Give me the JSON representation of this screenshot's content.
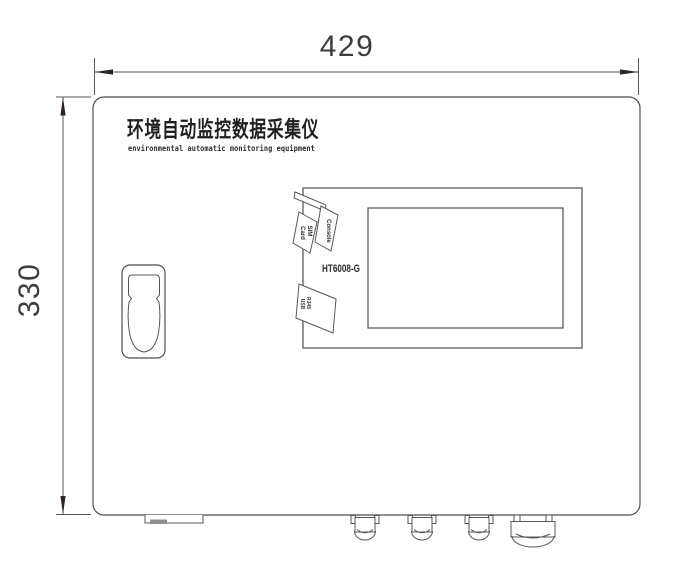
{
  "drawing": {
    "kind": "front-view engineering drawing of wall-mounted data collector cabinet",
    "colors": {
      "line": "#4f4c4c",
      "text": "#2e2e2e",
      "foot_fill": "#8f8f8f"
    }
  },
  "dimensions": {
    "width_label": "429",
    "height_label": "330"
  },
  "device": {
    "title_cn": "环境自动监控数据采集仪",
    "title_en": "environmental automatic monitoring equipment",
    "model": "HT6008-G",
    "ports": {
      "console": "Console",
      "sim_line1": "SIM",
      "sim_line2": "Card",
      "port_line1": "RJ45",
      "port_line2": "USB"
    }
  }
}
